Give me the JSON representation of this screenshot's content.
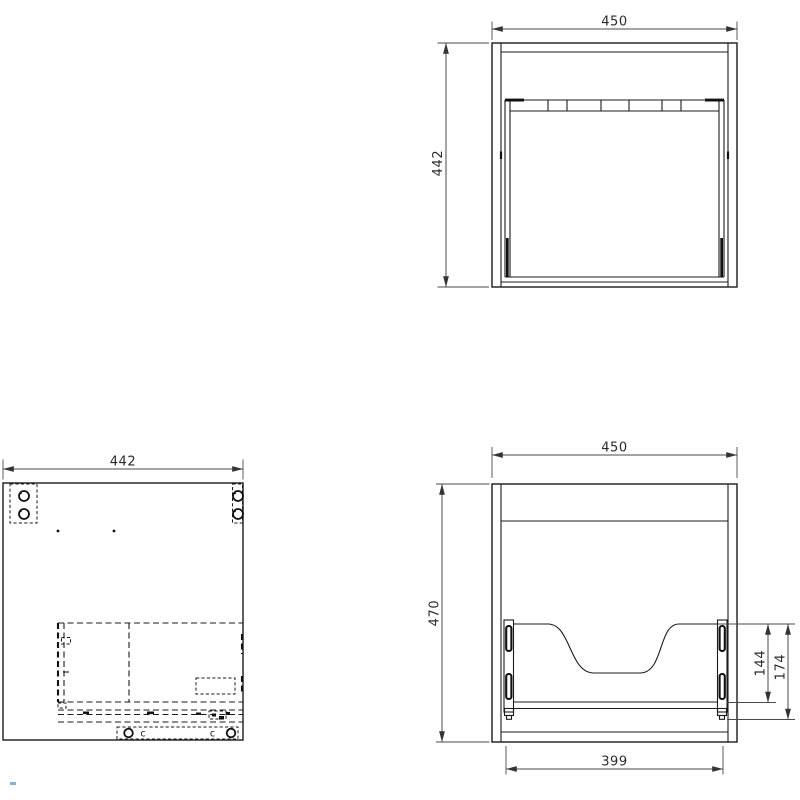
{
  "colors": {
    "background": "#ffffff",
    "line": "#1b1b1b",
    "dimension_line": "#4a4a4a",
    "accent_mark": "#8ab0d9"
  },
  "front_view": {
    "width_dim": "450",
    "height_dim": "442"
  },
  "side_view": {
    "width_dim": "442",
    "cam_letters": [
      "c",
      "c"
    ]
  },
  "back_view": {
    "width_dim": "450",
    "height_dim": "470",
    "opening_width_dim": "399",
    "rail_height_dim": "144",
    "rail_total_height_dim": "174"
  }
}
